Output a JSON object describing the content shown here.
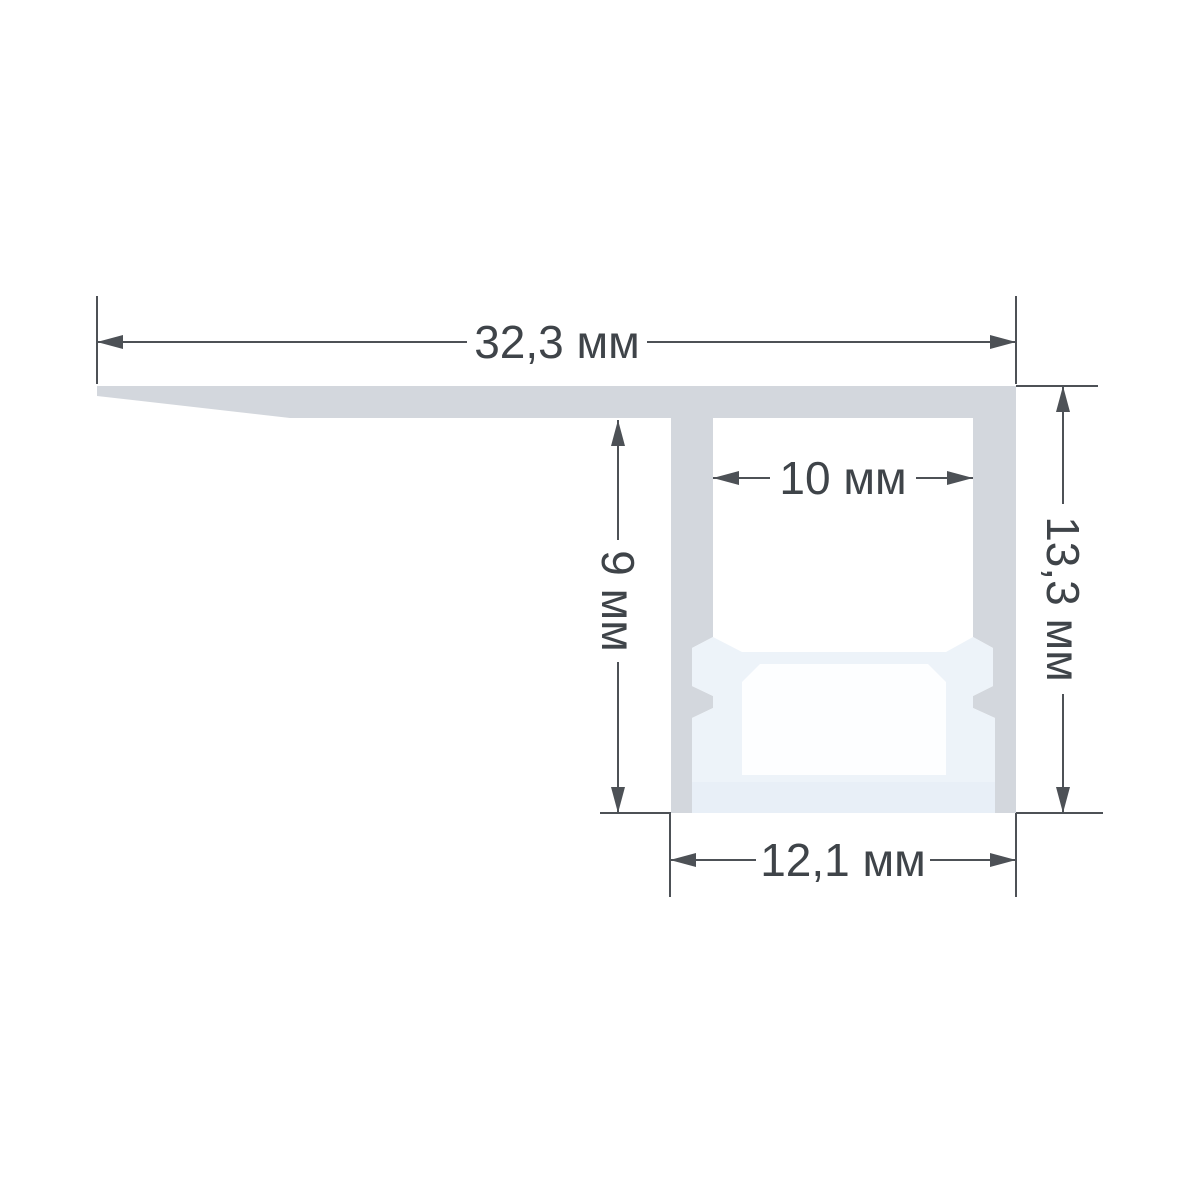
{
  "drawing": {
    "kind": "profile-cross-section-dimension-drawing",
    "unit": "мм",
    "dimensions": {
      "overall_width": {
        "label": "32,3 мм",
        "value": 32.3,
        "unit": "мм",
        "orientation": "horizontal",
        "position": "top"
      },
      "slot_width": {
        "label": "10 мм",
        "value": 10,
        "unit": "мм",
        "orientation": "horizontal",
        "position": "inner-channel"
      },
      "inner_depth": {
        "label": "9 мм",
        "value": 9,
        "unit": "мм",
        "orientation": "vertical",
        "position": "left"
      },
      "overall_height": {
        "label": "13,3 мм",
        "value": 13.3,
        "unit": "мм",
        "orientation": "vertical",
        "position": "right"
      },
      "base_width": {
        "label": "12,1 мм",
        "value": 12.1,
        "unit": "мм",
        "orientation": "horizontal",
        "position": "bottom"
      }
    },
    "colors": {
      "background": "#ffffff",
      "aluminum": "#d3d7dd",
      "insert": "#edf3f9",
      "cavity": "#fdfeff",
      "floor": "#e8eff7",
      "line": "#4d5156",
      "text": "#3f4449"
    }
  }
}
